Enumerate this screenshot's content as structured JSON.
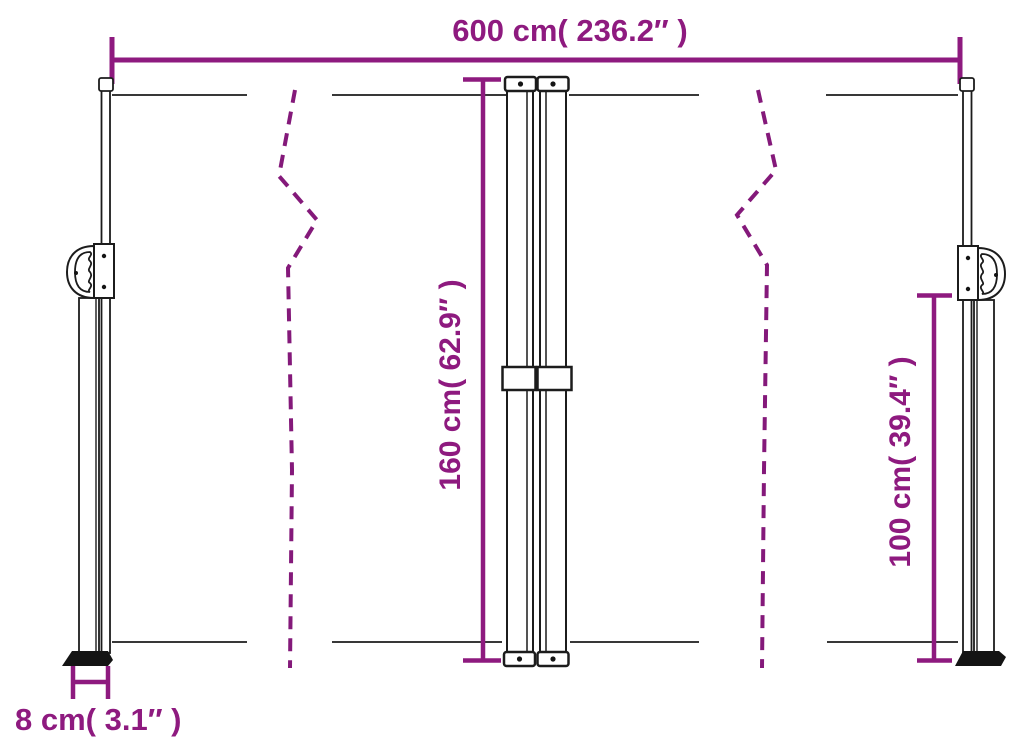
{
  "colors": {
    "dimension_accent": "#8E1A7F",
    "fold_line": "#84197A",
    "drawing_line": "#1C1C1C",
    "background": "#FFFFFF"
  },
  "diagram": {
    "dimensions": {
      "total_width": {
        "label": "600 cm( 236.2″  )",
        "cm": "600",
        "inches": "236.2"
      },
      "total_height": {
        "label": "160 cm( 62.9″  )",
        "cm": "160",
        "inches": "62.9"
      },
      "side_post_height": {
        "label": "100 cm( 39.4″  )",
        "cm": "100",
        "inches": "39.4"
      },
      "base_depth": {
        "label": "8 cm( 3.1″  )",
        "cm": "8",
        "inches": "3.1"
      }
    }
  }
}
